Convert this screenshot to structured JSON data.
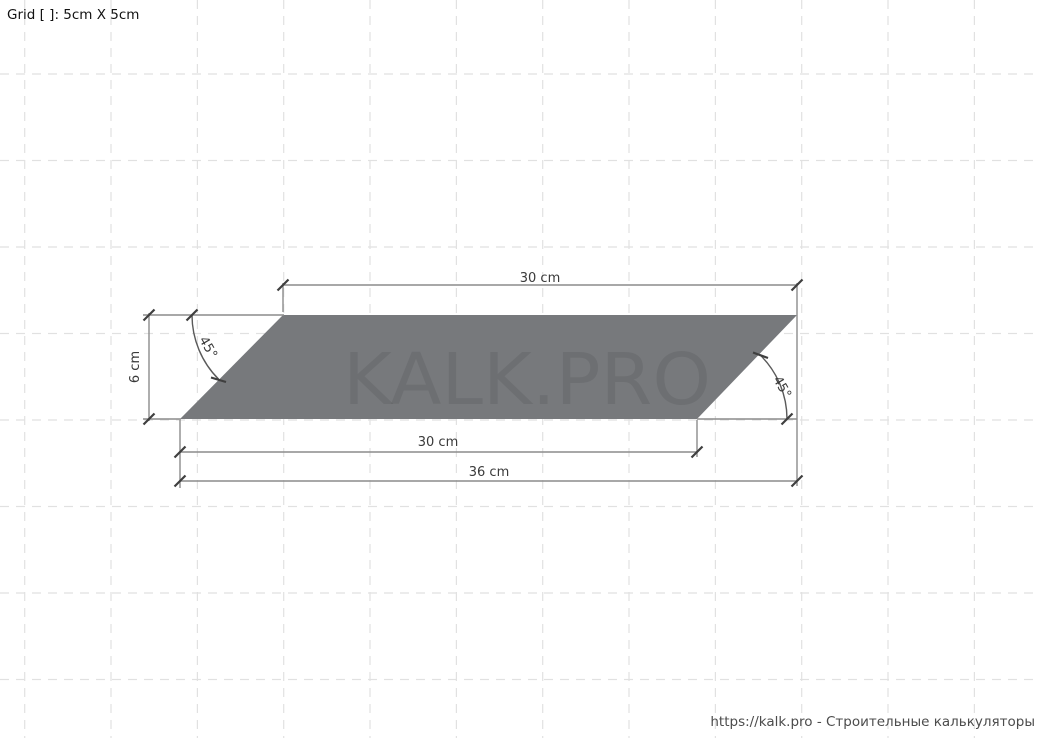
{
  "canvas": {
    "grid_label": "Grid [ ]: 5cm X 5cm",
    "watermark": "KALK.PRO",
    "footer": "https://kalk.pro - Строительные калькуляторы"
  },
  "drawing": {
    "dimensions": {
      "top_width": "30 cm",
      "height": "6 cm",
      "bottom_width": "30 cm",
      "overall_width": "36 cm",
      "left_angle": "45°",
      "right_angle": "45°"
    }
  },
  "colors": {
    "background": "#ffffff",
    "grid_line": "#e1e1e1",
    "shape_fill": "#77797c",
    "dim_line": "#8c8c8c",
    "arc_line": "#5a5a5a",
    "tick": "#3f3f3f",
    "label": "#3a3a3a",
    "grid_label_text": "#121212",
    "footer_text": "#4c4c4c"
  }
}
